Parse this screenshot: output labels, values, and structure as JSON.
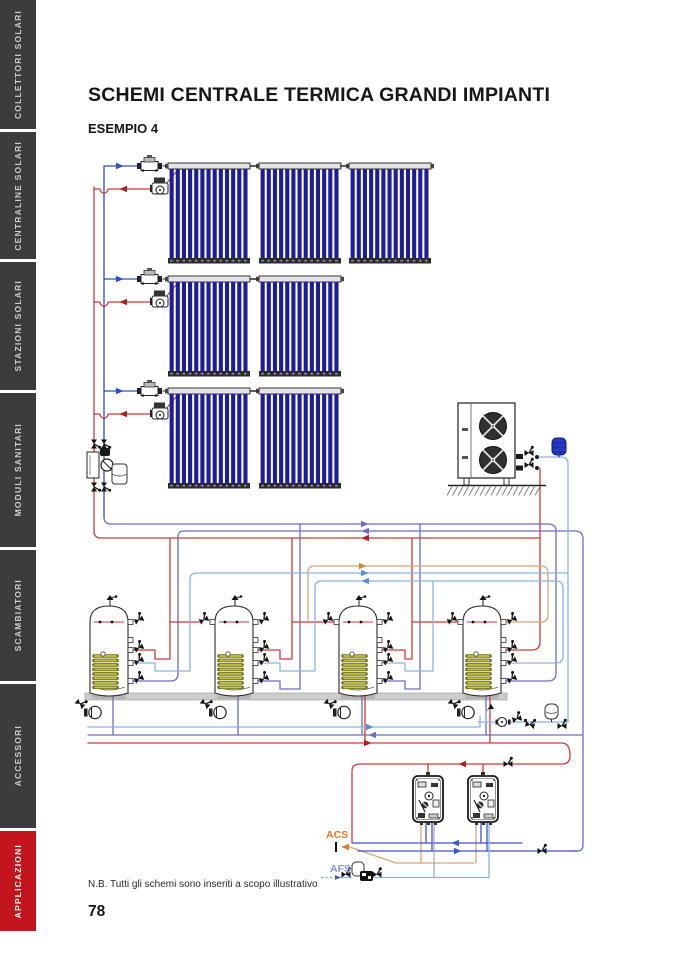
{
  "sidebar": {
    "tabs": [
      {
        "id": "collettori-solari",
        "label": "COLLETTORI SOLARI",
        "active": false
      },
      {
        "id": "centraline-solari",
        "label": "CENTRALINE SOLARI",
        "active": false
      },
      {
        "id": "stazioni-solari",
        "label": "STAZIONI SOLARI",
        "active": false
      },
      {
        "id": "moduli-sanitari",
        "label": "MODULI SANITARI",
        "active": false
      },
      {
        "id": "scambiatori",
        "label": "SCAMBIATORI",
        "active": false
      },
      {
        "id": "accessori",
        "label": "ACCESSORI",
        "active": false
      },
      {
        "id": "applicazioni",
        "label": "APPLICAZIONI",
        "active": true
      }
    ],
    "tab_color": "#3c3c3e",
    "active_tab_color": "#c2151e"
  },
  "header": {
    "title": "SCHEMI CENTRALE TERMICA GRANDI IMPIANTI",
    "example_label": "ESEMPIO 4"
  },
  "diagram": {
    "labels": {
      "acs": "ACS",
      "afs": "AFS"
    },
    "colors": {
      "solar_supply_blue": "#2e4fc4",
      "solar_return_red": "#cb3b3b",
      "heating_purple": "#6d6dc4",
      "cold_water_lightblue": "#8ab4e0",
      "dhw_tan": "#d3a87c",
      "module_blue": "#4455c5",
      "acs_orange": "#e0782a",
      "afs_blue": "#8099d6",
      "collector_tube": "#1d1d9c",
      "coil_yellow": "#c6c63e"
    }
  },
  "footer": {
    "note": "N.B. Tutti gli schemi sono inseriti a scopo illustrativo",
    "page_number": "78"
  }
}
